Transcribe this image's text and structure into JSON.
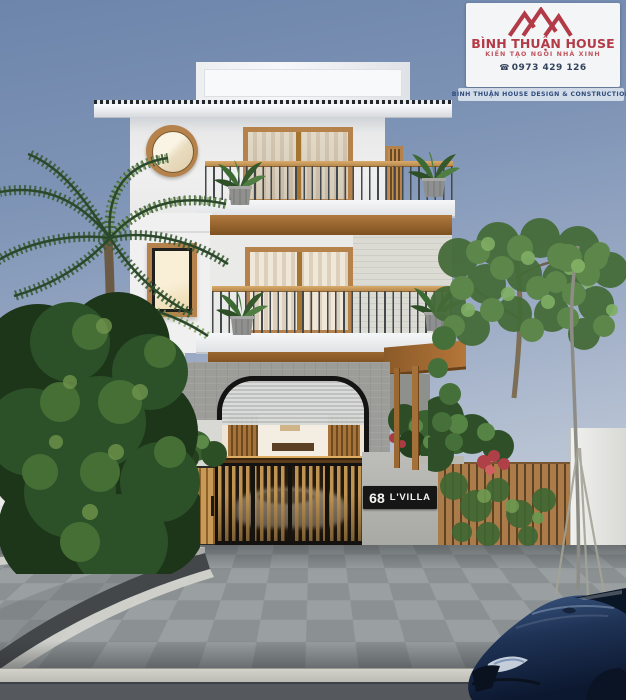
{
  "brand_card": {
    "logo_icon": "mountain-peaks-logo",
    "name": "BÌNH THUẬN HOUSE",
    "tagline": "KIẾN TẠO NGÔI NHÀ XINH",
    "phone_icon": "phone-icon",
    "phone_icon_glyph": "☎",
    "phone": "0973 429 126",
    "footer": "BÌNH THUẬN HOUSE DESIGN & CONSTRUCTION",
    "colors": {
      "brand_red": "#b23b47",
      "phone_text": "#33435c",
      "footer_text": "#2f4c7c",
      "card_bg": "#f3f5f7"
    }
  },
  "villa_sign": {
    "number": "68",
    "name": "L'VILLA",
    "colors": {
      "plate_bg": "#161616",
      "text": "#f4f4f2"
    }
  },
  "scene_palette": {
    "sky_top": "#6d85ab",
    "sky_horizon": "#c3ccd9",
    "facade_white": "#efefef",
    "wood_frame": "#b5824c",
    "soffit_wood": "#8a5a28",
    "stone_wall": "#9c9c98",
    "gate_wood": "#bf9352",
    "foliage_dark": "#24401f",
    "foliage_light": "#6f9c52",
    "pavement_grey": "#949a9c",
    "asphalt": "#55585c",
    "car_navy": "#1b2a45"
  }
}
